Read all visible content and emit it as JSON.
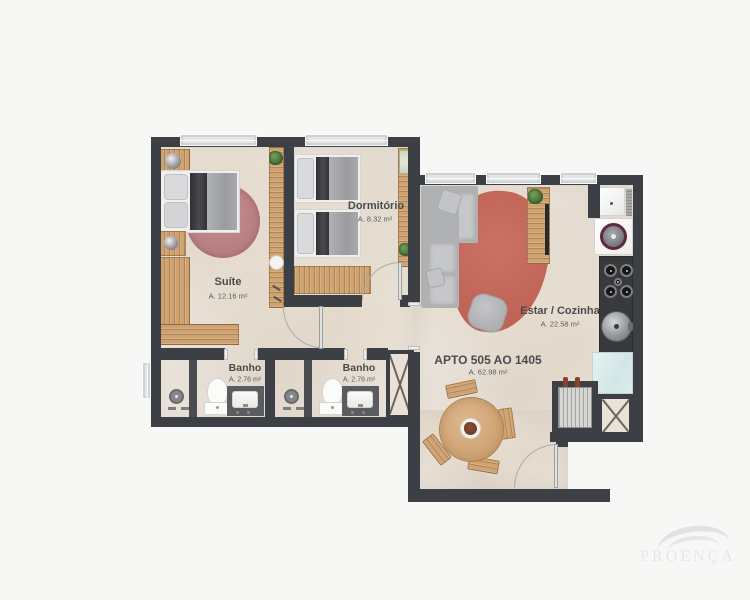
{
  "plan": {
    "apartment": {
      "title": "APTO 505 AO 1405",
      "area": "A. 62.98 m²"
    },
    "rooms": [
      {
        "id": "suite",
        "name": "Suíte",
        "area": "A. 12.16 m²"
      },
      {
        "id": "dormitorio",
        "name": "Dormitório",
        "area": "A. 8.32 m²"
      },
      {
        "id": "banho-1",
        "name": "Banho",
        "area": "A. 2.76 m²"
      },
      {
        "id": "banho-2",
        "name": "Banho",
        "area": "A. 2.76 m²"
      },
      {
        "id": "estar-cozinha",
        "name": "Estar / Cozinha",
        "area": "A. 22.58 m²"
      }
    ],
    "colors": {
      "background": "#f7f7f6",
      "wall": "#3c3f43",
      "floor": "#eae3da",
      "wood": "#cfa271",
      "suite_rug": "#bd8386",
      "living_rug": "#c3685c",
      "glass_counter": "#dcebeb"
    }
  },
  "branding": {
    "logo_text": "PROENÇA"
  }
}
